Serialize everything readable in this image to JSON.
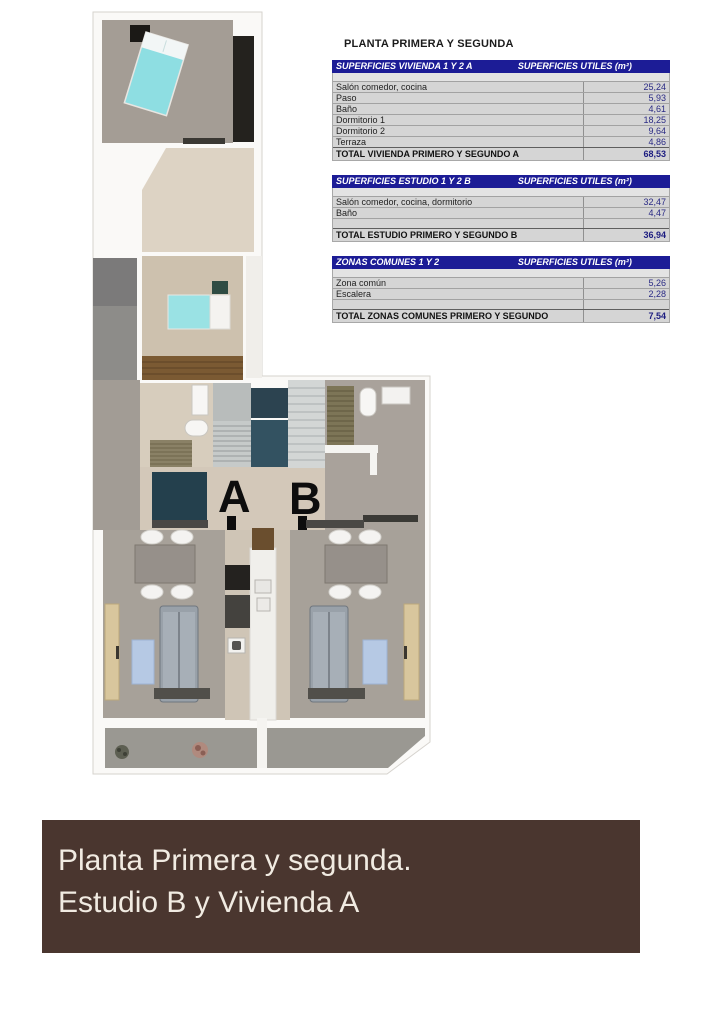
{
  "colors": {
    "table_header_navy": "#1c1c96",
    "table_body_grey": "#d5d5d5",
    "table_value_navy": "#2b2b85",
    "banner_background": "#4a362f",
    "banner_text": "#f1ebe2",
    "bed_cyan": "#8edee2",
    "wall_white": "#faf9f7"
  },
  "tables_panel": {
    "title": "PLANTA PRIMERA Y SEGUNDA",
    "tables": [
      {
        "header_left": "SUPERFICIES VIVIENDA 1 Y 2 A",
        "header_right": "SUPERFICIES UTILES  (m²)",
        "rows": [
          {
            "label": "Salón comedor, cocina",
            "value": "25,24"
          },
          {
            "label": "Paso",
            "value": "5,93"
          },
          {
            "label": "Baño",
            "value": "4,61"
          },
          {
            "label": "Dormitorio 1",
            "value": "18,25"
          },
          {
            "label": "Dormitorio 2",
            "value": "9,64"
          },
          {
            "label": "Terraza",
            "value": "4,86"
          }
        ],
        "total_label": "TOTAL VIVIENDA PRIMERO Y SEGUNDO A",
        "total_value": "68,53"
      },
      {
        "header_left": "SUPERFICIES ESTUDIO 1 Y 2 B",
        "header_right": "SUPERFICIES UTILES  (m²)",
        "rows": [
          {
            "label": "Salón comedor, cocina, dormitorio",
            "value": "32,47"
          },
          {
            "label": "Baño",
            "value": "4,47"
          }
        ],
        "total_label": "TOTAL ESTUDIO PRIMERO Y SEGUNDO B",
        "total_value": "36,94"
      },
      {
        "header_left": "ZONAS COMUNES 1 Y 2",
        "header_right": "SUPERFICIES UTILES  (m²)",
        "rows": [
          {
            "label": "Zona común",
            "value": "5,26"
          },
          {
            "label": "Escalera",
            "value": "2,28"
          }
        ],
        "total_label": "TOTAL ZONAS COMUNES PRIMERO Y SEGUNDO",
        "total_value": "7,54"
      }
    ]
  },
  "floorplan": {
    "unit_a_label": "A",
    "unit_b_label": "B"
  },
  "banner": {
    "line1": "Planta Primera y segunda.",
    "line2": "Estudio B y Vivienda A"
  }
}
